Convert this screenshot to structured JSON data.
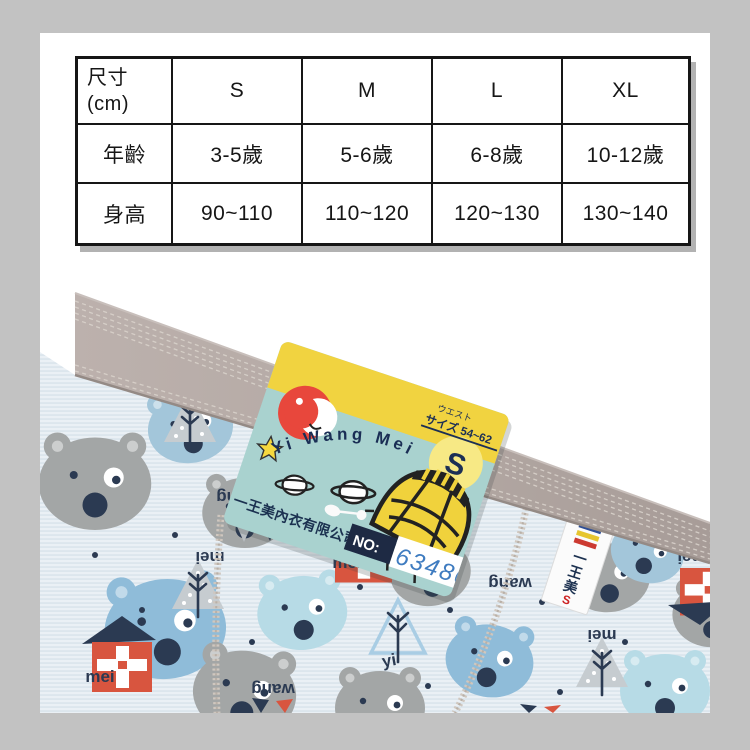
{
  "page": {
    "background_color": "#c2c2c2",
    "card_color": "#ffffff"
  },
  "size_table": {
    "header_label_line1": "尺寸",
    "header_label_line2": "(cm)",
    "sizes": [
      "S",
      "M",
      "L",
      "XL"
    ],
    "rows": [
      {
        "label": "年齡",
        "values": [
          "3-5歲",
          "5-6歲",
          "6-8歲",
          "10-12歲"
        ]
      },
      {
        "label": "身高",
        "values": [
          "90~110",
          "110~120",
          "120~130",
          "130~140"
        ]
      }
    ]
  },
  "chart_data": {
    "type": "table",
    "columns": [
      "尺寸 (cm)",
      "S",
      "M",
      "L",
      "XL"
    ],
    "rows": [
      [
        "年齡",
        "3-5歲",
        "5-6歲",
        "6-8歲",
        "10-12歲"
      ],
      [
        "身高",
        "90~110",
        "110~120",
        "120~130",
        "130~140"
      ]
    ]
  },
  "product_photo": {
    "hang_tag": {
      "brand_text": "Yi Wang Mei",
      "company_name": "一王美內衣有限公司",
      "waist_line1": "ウエスト",
      "waist_line2": "サイズ 54~62",
      "size_letter": "S",
      "no_label": "NO:",
      "no_number": "63486",
      "band_color": "#f1d340",
      "body_color": "#a9d2cf",
      "logo_color": "#e8473c"
    },
    "woven_label": {
      "char_1": "一",
      "char_2": "王",
      "char_3": "美",
      "size_letter": "S"
    },
    "fabric_words": {
      "wang": "wang",
      "mei": "mei",
      "yi": "yi"
    },
    "colors": {
      "waistband": "#b3a8a3",
      "fabric_base": "#eaf0f5",
      "fabric_stripe": "#d6e1ea",
      "bear_grey": "#a3a6a6",
      "bear_blue": "#8fbcd9",
      "bear_lightblue": "#b7dbe6",
      "bear_bluegrey": "#a3c6da",
      "house_red": "#d8553f",
      "print_navy": "#2b3a52"
    }
  }
}
